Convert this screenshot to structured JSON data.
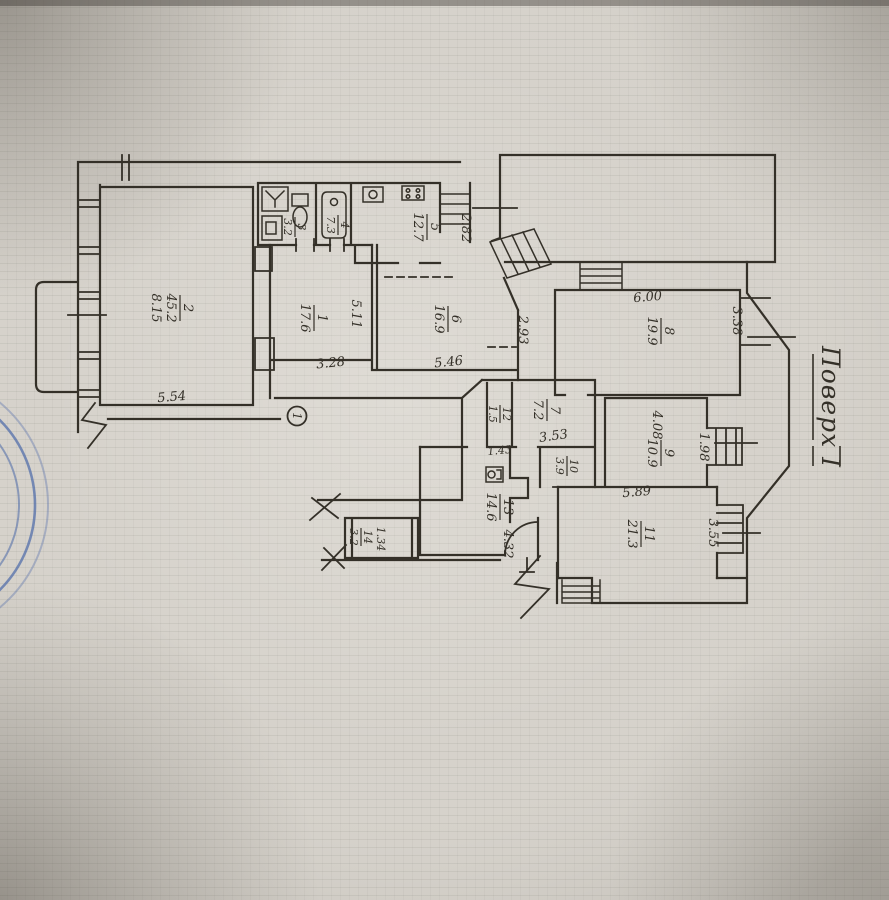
{
  "title": {
    "text": "Поверх I"
  },
  "marker": {
    "text": "1"
  },
  "rooms": [
    {
      "num": "1",
      "area": "17.6"
    },
    {
      "num": "2",
      "area": "45.2"
    },
    {
      "num": "3",
      "area": "3.2"
    },
    {
      "num": "4",
      "area": "7.3"
    },
    {
      "num": "5",
      "area": "12.7"
    },
    {
      "num": "6",
      "area": "16.9"
    },
    {
      "num": "7",
      "area": "7.2"
    },
    {
      "num": "8",
      "area": "19.9"
    },
    {
      "num": "9",
      "area": "10.9"
    },
    {
      "num": "10",
      "area": "3.9"
    },
    {
      "num": "11",
      "area": "21.3"
    },
    {
      "num": "12",
      "area": "1.5"
    },
    {
      "num": "13",
      "area": "14.6"
    },
    {
      "num": "14",
      "area": "3.2"
    }
  ],
  "dims": [
    "8.15",
    "5.54",
    "5.11",
    "3.28",
    "2.82",
    "5.46",
    "2.93",
    "6.00",
    "3.38",
    "4.08",
    "1.98",
    "3.55",
    "5.89",
    "4.32",
    "1.43",
    "1.34",
    "3.53"
  ],
  "colors": {
    "ink": "#343028",
    "paper": "#d6d2cb",
    "stamp": "#4a68a8"
  }
}
